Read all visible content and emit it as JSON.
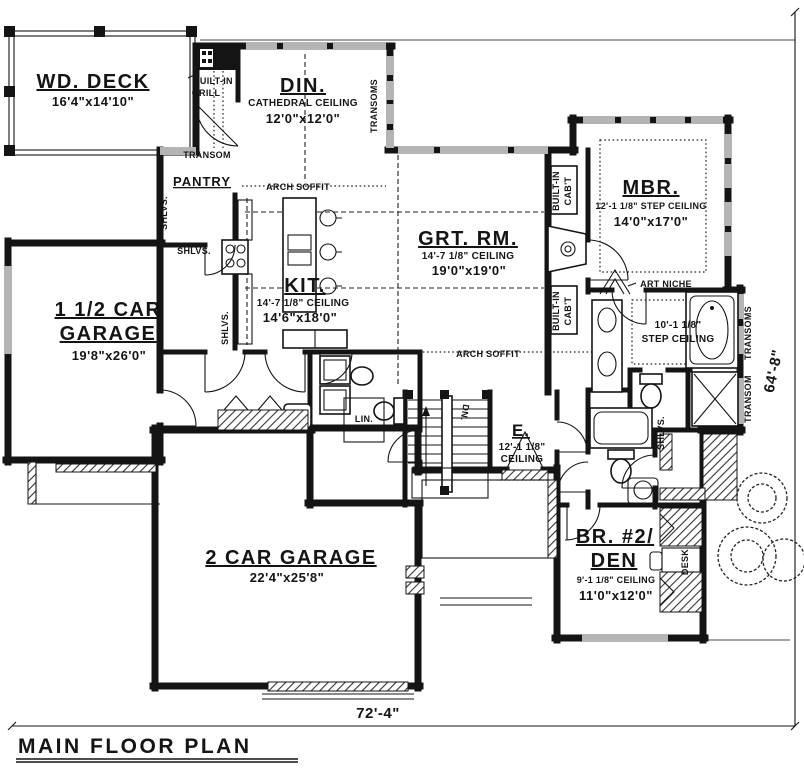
{
  "plan": {
    "title": "MAIN FLOOR PLAN",
    "width_dim": "72'-4\"",
    "height_dim": "64'-8\""
  },
  "rooms": {
    "deck": {
      "name": "WD. DECK",
      "size": "16'4\"x14'10\""
    },
    "dining": {
      "name": "DIN.",
      "ceiling": "CATHEDRAL CEILING",
      "size": "12'0\"x12'0\""
    },
    "master": {
      "name": "MBR.",
      "ceiling": "12'-1 1/8\" STEP CEILING",
      "size": "14'0\"x17'0\""
    },
    "great": {
      "name": "GRT. RM.",
      "ceiling": "14'-7 1/8\" CEILING",
      "size": "19'0\"x19'0\""
    },
    "kitchen": {
      "name": "KIT.",
      "ceiling": "14'-7 1/8\" CEILING",
      "size": "14'6\"x18'0\""
    },
    "garage_small": {
      "name_line1": "1 1/2 CAR",
      "name_line2": "GARAGE",
      "size": "19'8\"x26'0\""
    },
    "garage_large": {
      "name": "2 CAR GARAGE",
      "size": "22'4\"x25'8\""
    },
    "entry": {
      "name": "E.",
      "ceiling_line1": "12'-1 1/8\"",
      "ceiling_line2": "CEILING"
    },
    "bedroom2": {
      "name_line1": "BR. #2/",
      "name_line2": "DEN",
      "ceiling": "9'-1 1/8\" CEILING",
      "size": "11'0\"x12'0\""
    },
    "pantry": {
      "name": "PANTRY"
    },
    "master_bath": {
      "ceiling_line1": "10'-1 1/8\"",
      "ceiling_line2": "STEP CEILING"
    }
  },
  "labels": {
    "built_in_grill_line1": "BUILT-IN",
    "built_in_grill_line2": "GRILL",
    "transom": "TRANSOM",
    "transoms": "TRANSOMS",
    "arch_soffit": "ARCH SOFFIT",
    "shelves": "SHLVS.",
    "built_in_cab_line1": "BUILT-IN",
    "built_in_cab_line2": "CAB'T",
    "art_niche": "ART NICHE",
    "linen": "LIN.",
    "desk": "DESK",
    "down": "DN."
  }
}
